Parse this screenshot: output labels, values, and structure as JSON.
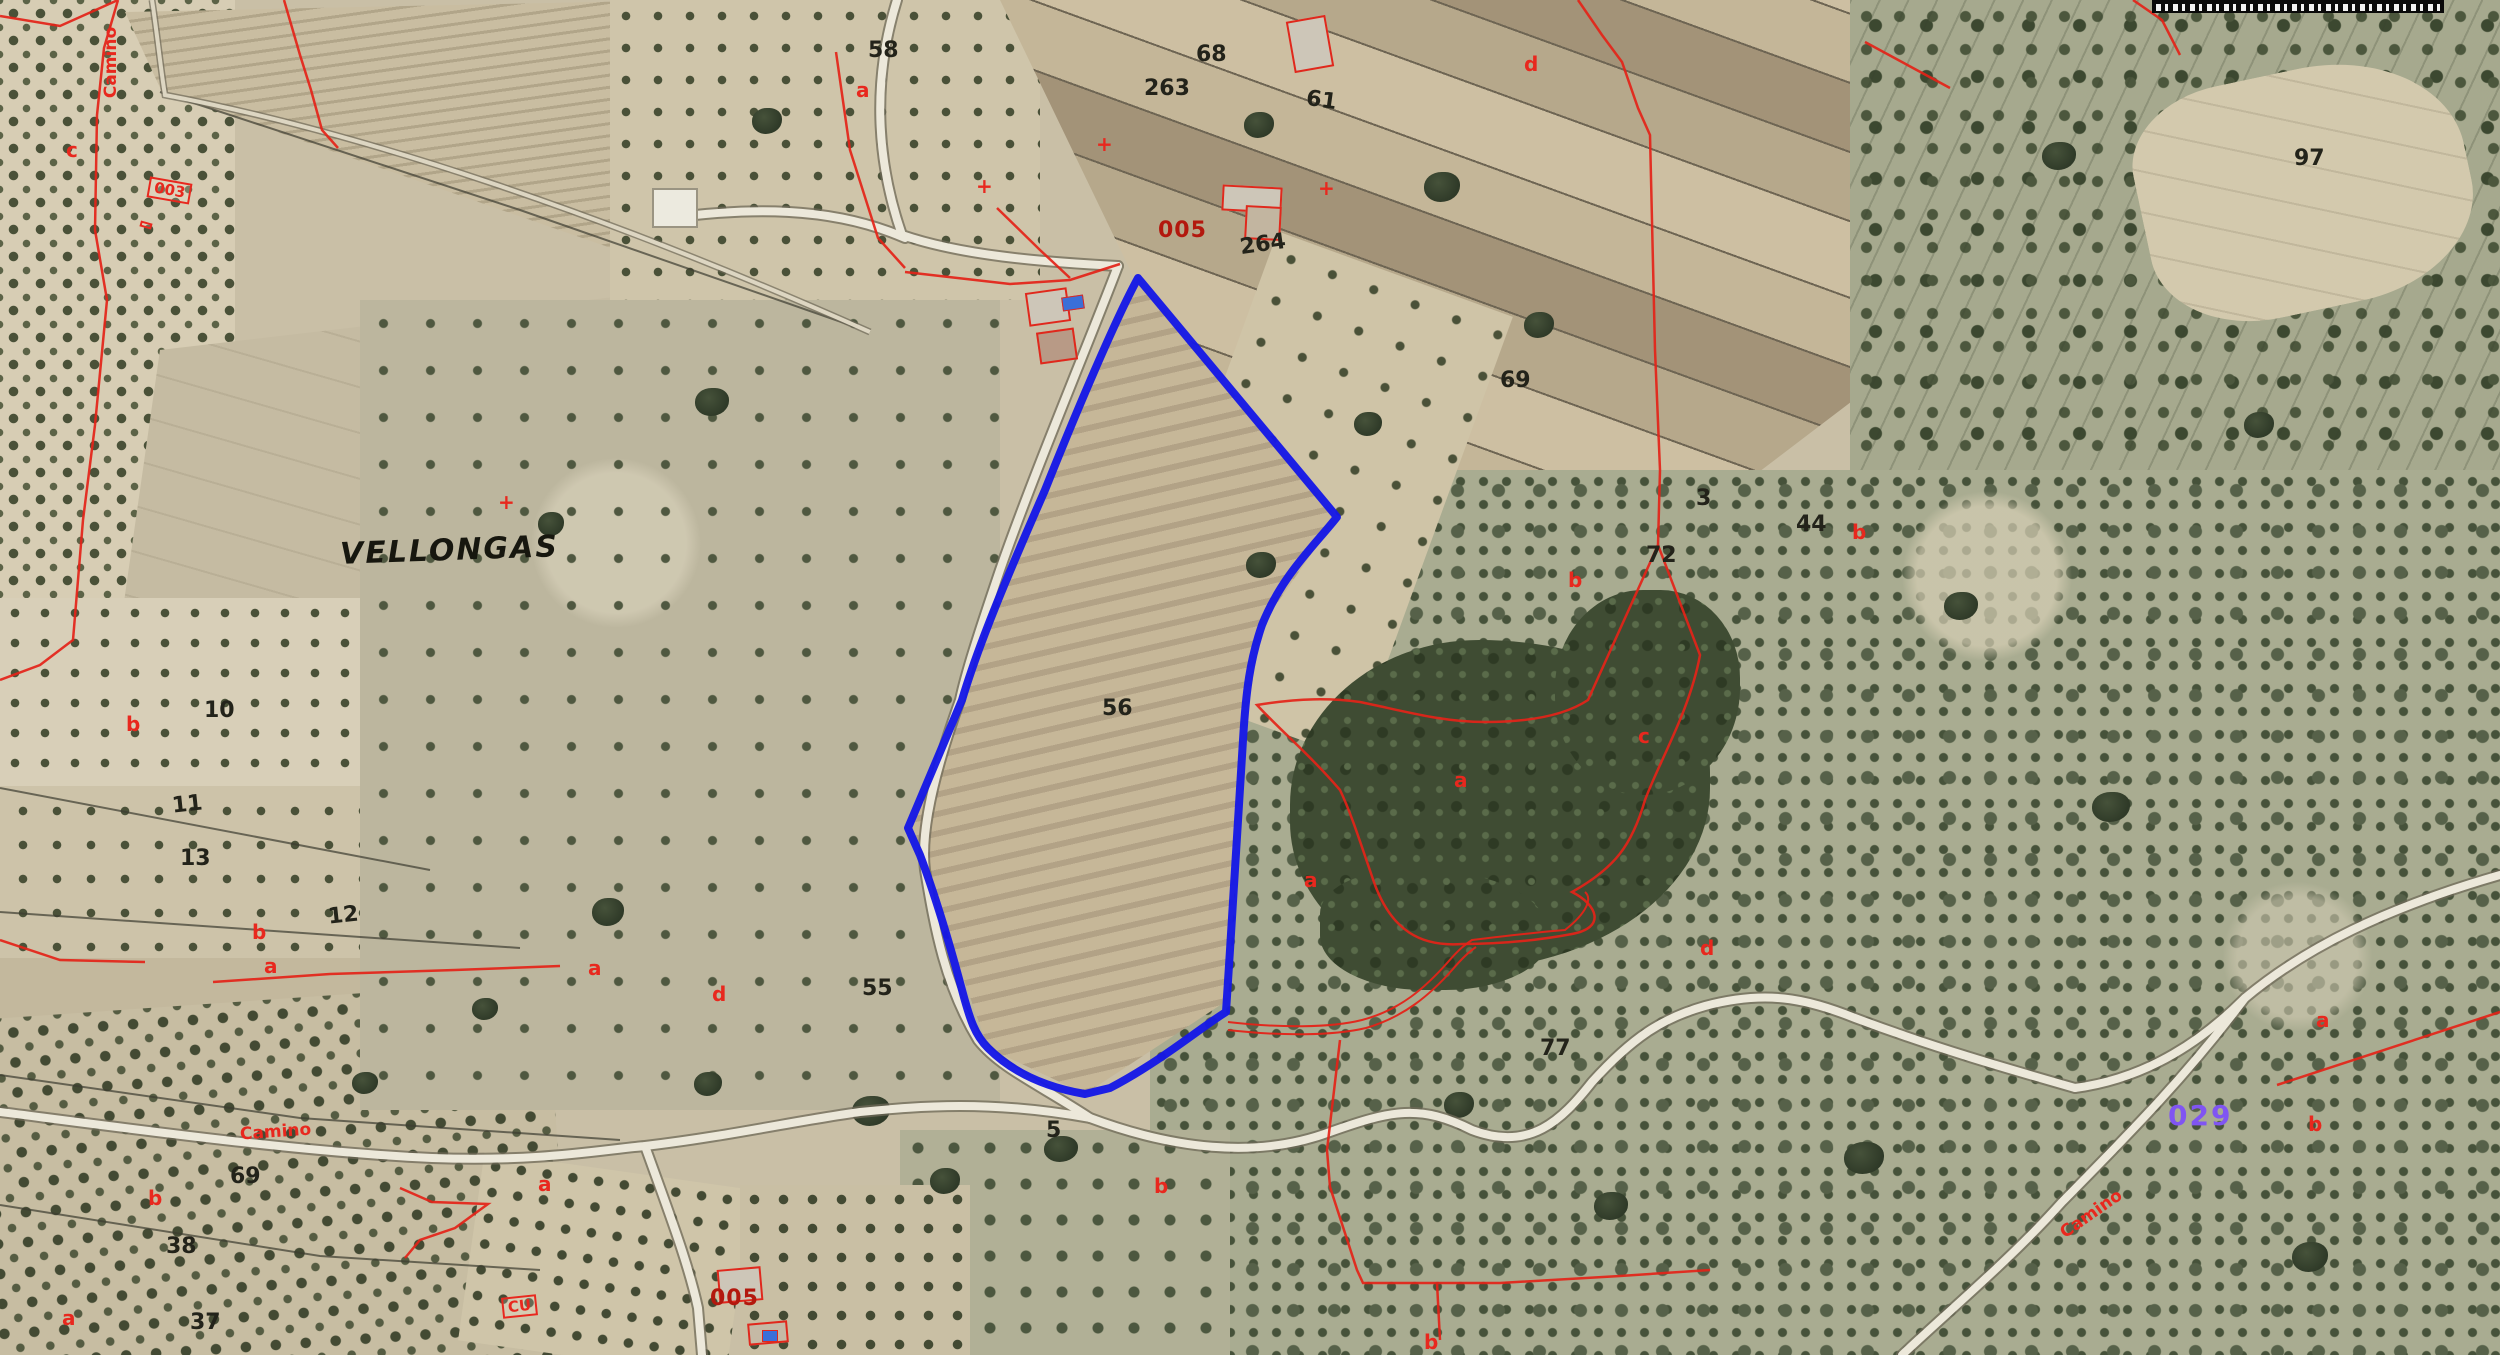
{
  "map": {
    "place_name": "VELLONGAS",
    "selected_parcel": {
      "number": "56",
      "outline_color": "#1518e6"
    },
    "colors": {
      "cadastral_line": "#e42318",
      "parcel_number": "#23231a",
      "subparcel_letter": "#e8281e",
      "municipality_code": "#8055f2",
      "building_code": "#b3180e"
    },
    "labels": [
      {
        "name": "toponym-vellongas",
        "type": "toponym",
        "text": "VELLONGAS",
        "x": 340,
        "y": 536,
        "rot": -2
      },
      {
        "name": "parcel-number-58",
        "type": "parcel-number",
        "text": "58",
        "x": 868,
        "y": 40,
        "rot": 0
      },
      {
        "name": "parcel-number-68",
        "type": "parcel-number",
        "text": "68",
        "x": 1196,
        "y": 44,
        "rot": 0
      },
      {
        "name": "parcel-number-263",
        "type": "parcel-number",
        "text": "263",
        "x": 1144,
        "y": 78,
        "rot": 0
      },
      {
        "name": "parcel-number-61",
        "type": "parcel-number",
        "text": "61",
        "x": 1306,
        "y": 90,
        "rot": 8
      },
      {
        "name": "parcel-number-97",
        "type": "parcel-number",
        "text": "97",
        "x": 2294,
        "y": 148,
        "rot": 0
      },
      {
        "name": "parcel-number-264",
        "type": "parcel-number",
        "text": "264",
        "x": 1240,
        "y": 234,
        "rot": -8
      },
      {
        "name": "parcel-number-69",
        "type": "parcel-number",
        "text": "69",
        "x": 1500,
        "y": 370,
        "rot": 0
      },
      {
        "name": "parcel-number-3",
        "type": "parcel-number",
        "text": "3",
        "x": 1696,
        "y": 488,
        "rot": 0
      },
      {
        "name": "parcel-number-44",
        "type": "parcel-number",
        "text": "44",
        "x": 1796,
        "y": 514,
        "rot": 0
      },
      {
        "name": "parcel-number-72",
        "type": "parcel-number",
        "text": "72",
        "x": 1646,
        "y": 545,
        "rot": 0
      },
      {
        "name": "parcel-number-56",
        "type": "parcel-number",
        "text": "56",
        "x": 1102,
        "y": 698,
        "rot": 0
      },
      {
        "name": "parcel-number-10",
        "type": "parcel-number",
        "text": "10",
        "x": 204,
        "y": 700,
        "rot": 0
      },
      {
        "name": "parcel-number-11",
        "type": "parcel-number",
        "text": "11",
        "x": 172,
        "y": 794,
        "rot": -6
      },
      {
        "name": "parcel-number-13",
        "type": "parcel-number",
        "text": "13",
        "x": 180,
        "y": 848,
        "rot": 0
      },
      {
        "name": "parcel-number-12",
        "type": "parcel-number",
        "text": "12",
        "x": 328,
        "y": 905,
        "rot": -6
      },
      {
        "name": "parcel-number-55",
        "type": "parcel-number",
        "text": "55",
        "x": 862,
        "y": 978,
        "rot": 0
      },
      {
        "name": "parcel-number-77",
        "type": "parcel-number",
        "text": "77",
        "x": 1540,
        "y": 1038,
        "rot": 0
      },
      {
        "name": "parcel-number-69b",
        "type": "parcel-number",
        "text": "69",
        "x": 230,
        "y": 1166,
        "rot": 0
      },
      {
        "name": "parcel-number-38",
        "type": "parcel-number",
        "text": "38",
        "x": 166,
        "y": 1236,
        "rot": 0
      },
      {
        "name": "parcel-number-37",
        "type": "parcel-number",
        "text": "37",
        "x": 190,
        "y": 1312,
        "rot": 0
      },
      {
        "name": "parcel-number-5",
        "type": "parcel-number",
        "text": "5",
        "x": 1046,
        "y": 1120,
        "rot": 0
      },
      {
        "name": "subparcel-a-1",
        "type": "subparcel-letter",
        "text": "a",
        "x": 856,
        "y": 80,
        "rot": 0
      },
      {
        "name": "subparcel-c-1",
        "type": "subparcel-letter",
        "text": "c",
        "x": 66,
        "y": 140,
        "rot": 0
      },
      {
        "name": "subparcel-d-1",
        "type": "subparcel-letter",
        "text": "d",
        "x": 1524,
        "y": 54,
        "rot": 0
      },
      {
        "name": "subparcel-b-1",
        "type": "subparcel-letter",
        "text": "b",
        "x": 126,
        "y": 714,
        "rot": 0
      },
      {
        "name": "subparcel-b-2",
        "type": "subparcel-letter",
        "text": "b",
        "x": 252,
        "y": 922,
        "rot": 0
      },
      {
        "name": "subparcel-a-2",
        "type": "subparcel-letter",
        "text": "a",
        "x": 264,
        "y": 956,
        "rot": 0
      },
      {
        "name": "subparcel-a-3",
        "type": "subparcel-letter",
        "text": "a",
        "x": 588,
        "y": 958,
        "rot": 0
      },
      {
        "name": "subparcel-d-2",
        "type": "subparcel-letter",
        "text": "d",
        "x": 712,
        "y": 984,
        "rot": 0
      },
      {
        "name": "subparcel-a-4",
        "type": "subparcel-letter",
        "text": "a",
        "x": 538,
        "y": 1174,
        "rot": 0
      },
      {
        "name": "subparcel-b-3",
        "type": "subparcel-letter",
        "text": "b",
        "x": 148,
        "y": 1188,
        "rot": 0
      },
      {
        "name": "subparcel-a-5",
        "type": "subparcel-letter",
        "text": "a",
        "x": 62,
        "y": 1308,
        "rot": 0
      },
      {
        "name": "subparcel-b-4",
        "type": "subparcel-letter",
        "text": "b",
        "x": 1154,
        "y": 1176,
        "rot": 0
      },
      {
        "name": "subparcel-b-5",
        "type": "subparcel-letter",
        "text": "b",
        "x": 1424,
        "y": 1332,
        "rot": 0
      },
      {
        "name": "subparcel-b-6",
        "type": "subparcel-letter",
        "text": "b",
        "x": 1568,
        "y": 570,
        "rot": 0
      },
      {
        "name": "subparcel-b-7",
        "type": "subparcel-letter",
        "text": "b",
        "x": 1852,
        "y": 522,
        "rot": 0
      },
      {
        "name": "subparcel-a-6",
        "type": "subparcel-letter",
        "text": "a",
        "x": 1454,
        "y": 770,
        "rot": 0
      },
      {
        "name": "subparcel-a-7",
        "type": "subparcel-letter",
        "text": "a",
        "x": 1304,
        "y": 870,
        "rot": 0
      },
      {
        "name": "subparcel-d-3",
        "type": "subparcel-letter",
        "text": "d",
        "x": 1700,
        "y": 938,
        "rot": 0
      },
      {
        "name": "subparcel-c-2",
        "type": "subparcel-letter",
        "text": "c",
        "x": 1638,
        "y": 726,
        "rot": 0
      },
      {
        "name": "subparcel-a-8",
        "type": "subparcel-letter",
        "text": "a",
        "x": 2316,
        "y": 1010,
        "rot": 0
      },
      {
        "name": "subparcel-b-8",
        "type": "subparcel-letter",
        "text": "b",
        "x": 2308,
        "y": 1114,
        "rot": 0
      },
      {
        "name": "survey-cross-1",
        "type": "survey-cross",
        "text": "+",
        "x": 1096,
        "y": 134,
        "rot": 0
      },
      {
        "name": "survey-cross-2",
        "type": "survey-cross",
        "text": "+",
        "x": 976,
        "y": 176,
        "rot": 0
      },
      {
        "name": "survey-cross-3",
        "type": "survey-cross",
        "text": "+",
        "x": 1318,
        "y": 178,
        "rot": 0
      },
      {
        "name": "survey-cross-4",
        "type": "survey-cross",
        "text": "+",
        "x": 498,
        "y": 492,
        "rot": 0
      },
      {
        "name": "camino-label-topleft",
        "type": "camino",
        "text": "Camino",
        "x": 76,
        "y": 54,
        "rot": -90
      },
      {
        "name": "camino-label-bottomleft",
        "type": "camino",
        "text": "Camino",
        "x": 240,
        "y": 1124,
        "rot": -4
      },
      {
        "name": "camino-label-bottomright",
        "type": "camino",
        "text": "Camino",
        "x": 2056,
        "y": 1206,
        "rot": -35
      },
      {
        "name": "building-code-003",
        "type": "code-box",
        "text": "003",
        "x": 148,
        "y": 180,
        "rot": 10
      },
      {
        "name": "building-outline-box",
        "type": "code-box",
        "text": "",
        "x": 140,
        "y": 222,
        "rot": 16
      },
      {
        "name": "building-code-cu",
        "type": "code-box",
        "text": "CU",
        "x": 502,
        "y": 1296,
        "rot": -6
      },
      {
        "name": "building-code-005-top",
        "type": "building-code",
        "text": "005",
        "x": 1158,
        "y": 220,
        "rot": 0
      },
      {
        "name": "building-code-005-bottom",
        "type": "building-code",
        "text": "005",
        "x": 710,
        "y": 1288,
        "rot": 0
      },
      {
        "name": "municipality-code-029",
        "type": "municipality-code",
        "text": "029",
        "x": 2168,
        "y": 1102,
        "rot": 0
      }
    ]
  }
}
